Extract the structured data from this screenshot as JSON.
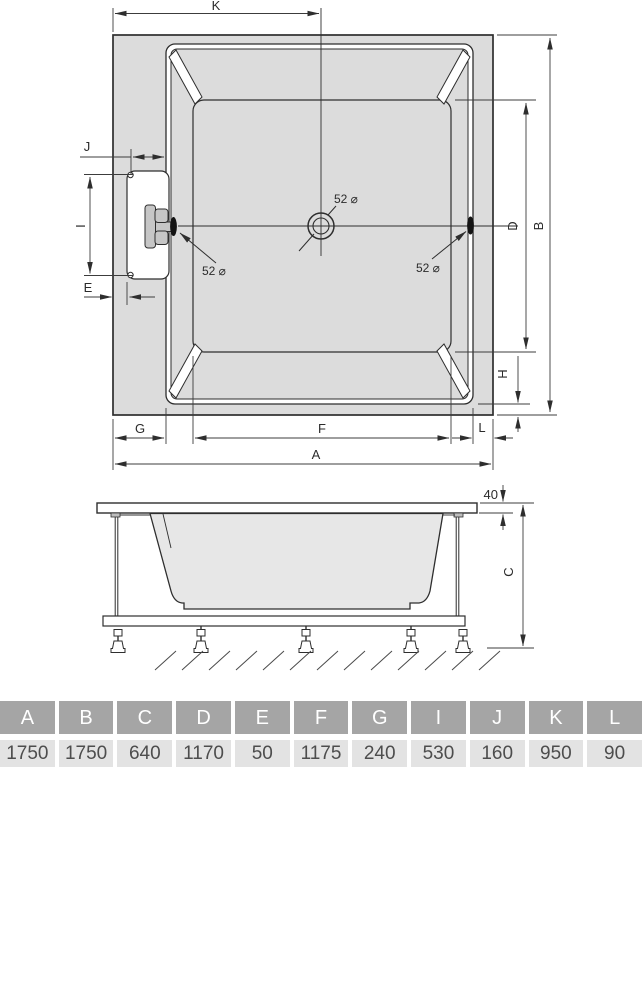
{
  "plan": {
    "dim_k": "K",
    "dim_j": "J",
    "dim_i": "I",
    "dim_e": "E",
    "dim_g": "G",
    "dim_f": "F",
    "dim_a": "A",
    "dim_l": "L",
    "dim_d": "D",
    "dim_b": "B",
    "dim_h": "H",
    "drain_label": "52 ⌀",
    "jet_left_label": "52 ⌀",
    "jet_right_label": "52 ⌀"
  },
  "side": {
    "rim_thickness": "40",
    "dim_c": "C"
  },
  "colors": {
    "line": "#2e2e2e",
    "dim_line": "#3c3c3c",
    "tub_fill": "#dcdcdc",
    "handle_fill": "#c6c6c6",
    "side_tub_fill": "#e7e7e7",
    "table_header_bg": "#a5a5a5",
    "table_header_text": "#ffffff",
    "table_value_bg": "#e3e3e3",
    "table_value_text": "#4d4d4d"
  },
  "table": {
    "columns": [
      {
        "letter": "A",
        "value": "1750"
      },
      {
        "letter": "B",
        "value": "1750"
      },
      {
        "letter": "C",
        "value": "640"
      },
      {
        "letter": "D",
        "value": "1170"
      },
      {
        "letter": "E",
        "value": "50"
      },
      {
        "letter": "F",
        "value": "1175"
      },
      {
        "letter": "G",
        "value": "240"
      },
      {
        "letter": "I",
        "value": "530"
      },
      {
        "letter": "J",
        "value": "160"
      },
      {
        "letter": "K",
        "value": "950"
      },
      {
        "letter": "L",
        "value": "90"
      }
    ]
  }
}
